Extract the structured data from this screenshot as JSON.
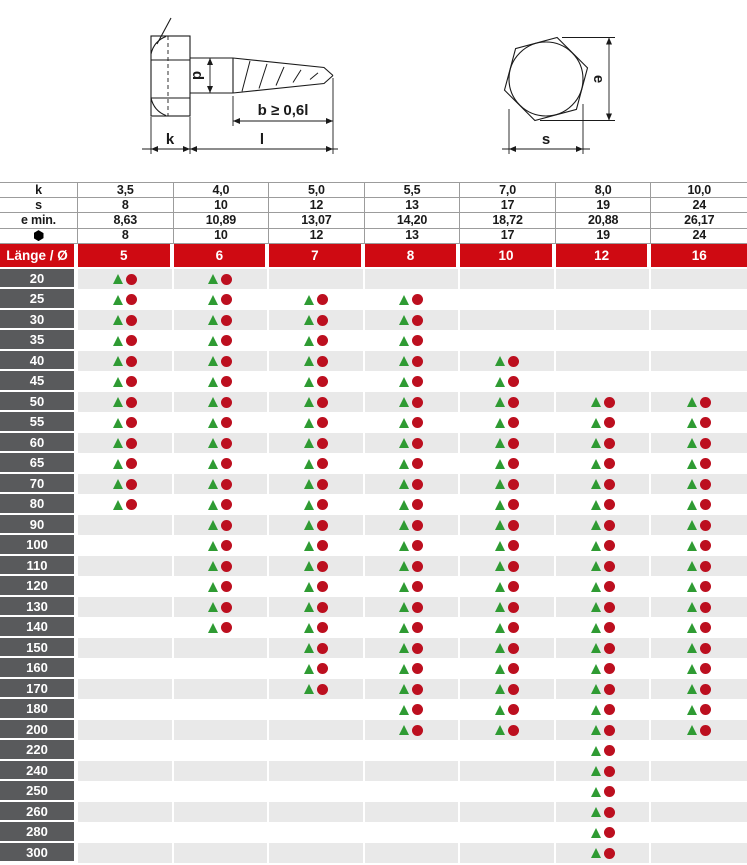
{
  "drawings": {
    "screw_side_view": {
      "d_label": "d",
      "b_label": "b ≥  0,6l",
      "k_label": "k",
      "l_label": "l"
    },
    "hex_top_view": {
      "e_label": "e",
      "s_label": "s"
    }
  },
  "spec_table": {
    "rows": [
      {
        "label": "k",
        "icon": "",
        "values": [
          "3,5",
          "4,0",
          "5,0",
          "5,5",
          "7,0",
          "8,0",
          "10,0"
        ]
      },
      {
        "label": "s",
        "icon": "",
        "values": [
          "8",
          "10",
          "12",
          "13",
          "17",
          "19",
          "24"
        ]
      },
      {
        "label": "e min.",
        "icon": "",
        "values": [
          "8,63",
          "10,89",
          "13,07",
          "14,20",
          "18,72",
          "20,88",
          "26,17"
        ]
      },
      {
        "label": "",
        "icon": "hexagon-icon",
        "values": [
          "8",
          "10",
          "12",
          "13",
          "17",
          "19",
          "24"
        ]
      }
    ]
  },
  "diameter_row": {
    "label": "Länge / Ø",
    "values": [
      "5",
      "6",
      "7",
      "8",
      "10",
      "12",
      "16"
    ]
  },
  "availability": {
    "columns": [
      "5",
      "6",
      "7",
      "8",
      "10",
      "12",
      "16"
    ],
    "rows": [
      {
        "length": "20",
        "marks": [
          1,
          1,
          0,
          0,
          0,
          0,
          0
        ]
      },
      {
        "length": "25",
        "marks": [
          1,
          1,
          1,
          1,
          0,
          0,
          0
        ]
      },
      {
        "length": "30",
        "marks": [
          1,
          1,
          1,
          1,
          0,
          0,
          0
        ]
      },
      {
        "length": "35",
        "marks": [
          1,
          1,
          1,
          1,
          0,
          0,
          0
        ]
      },
      {
        "length": "40",
        "marks": [
          1,
          1,
          1,
          1,
          1,
          0,
          0
        ]
      },
      {
        "length": "45",
        "marks": [
          1,
          1,
          1,
          1,
          1,
          0,
          0
        ]
      },
      {
        "length": "50",
        "marks": [
          1,
          1,
          1,
          1,
          1,
          1,
          1
        ]
      },
      {
        "length": "55",
        "marks": [
          1,
          1,
          1,
          1,
          1,
          1,
          1
        ]
      },
      {
        "length": "60",
        "marks": [
          1,
          1,
          1,
          1,
          1,
          1,
          1
        ]
      },
      {
        "length": "65",
        "marks": [
          1,
          1,
          1,
          1,
          1,
          1,
          1
        ]
      },
      {
        "length": "70",
        "marks": [
          1,
          1,
          1,
          1,
          1,
          1,
          1
        ]
      },
      {
        "length": "80",
        "marks": [
          1,
          1,
          1,
          1,
          1,
          1,
          1
        ]
      },
      {
        "length": "90",
        "marks": [
          0,
          1,
          1,
          1,
          1,
          1,
          1
        ]
      },
      {
        "length": "100",
        "marks": [
          0,
          1,
          1,
          1,
          1,
          1,
          1
        ]
      },
      {
        "length": "110",
        "marks": [
          0,
          1,
          1,
          1,
          1,
          1,
          1
        ]
      },
      {
        "length": "120",
        "marks": [
          0,
          1,
          1,
          1,
          1,
          1,
          1
        ]
      },
      {
        "length": "130",
        "marks": [
          0,
          1,
          1,
          1,
          1,
          1,
          1
        ]
      },
      {
        "length": "140",
        "marks": [
          0,
          1,
          1,
          1,
          1,
          1,
          1
        ]
      },
      {
        "length": "150",
        "marks": [
          0,
          0,
          1,
          1,
          1,
          1,
          1
        ]
      },
      {
        "length": "160",
        "marks": [
          0,
          0,
          1,
          1,
          1,
          1,
          1
        ]
      },
      {
        "length": "170",
        "marks": [
          0,
          0,
          1,
          1,
          1,
          1,
          1
        ]
      },
      {
        "length": "180",
        "marks": [
          0,
          0,
          0,
          1,
          1,
          1,
          1
        ]
      },
      {
        "length": "200",
        "marks": [
          0,
          0,
          0,
          1,
          1,
          1,
          1
        ]
      },
      {
        "length": "220",
        "marks": [
          0,
          0,
          0,
          0,
          0,
          1,
          0
        ]
      },
      {
        "length": "240",
        "marks": [
          0,
          0,
          0,
          0,
          0,
          1,
          0
        ]
      },
      {
        "length": "250",
        "marks": [
          0,
          0,
          0,
          0,
          0,
          1,
          0
        ]
      },
      {
        "length": "260",
        "marks": [
          0,
          0,
          0,
          0,
          0,
          1,
          0
        ]
      },
      {
        "length": "280",
        "marks": [
          0,
          0,
          0,
          0,
          0,
          1,
          0
        ]
      },
      {
        "length": "300",
        "marks": [
          0,
          0,
          0,
          0,
          0,
          1,
          0
        ]
      }
    ],
    "marker_glyphs": {
      "triangle": "▲",
      "circle": "●"
    }
  },
  "colors": {
    "header_red": "#cf0a12",
    "label_gray": "#595a5c",
    "row_stripe_gray": "#e9e9e9",
    "grid_line_gray": "#9c9c9c",
    "marker_green": "#2f9b33",
    "marker_red": "#bc0f1f",
    "drawing_black": "#1a1a1a"
  }
}
